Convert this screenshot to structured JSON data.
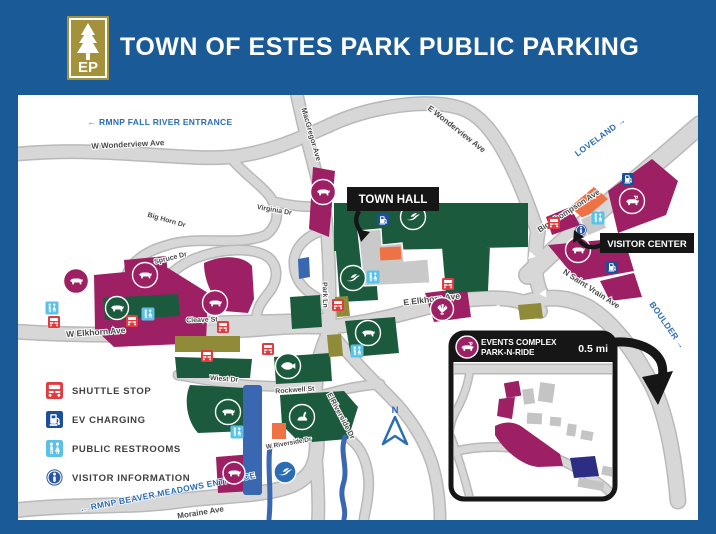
{
  "header": {
    "title": "TOWN OF ESTES PARK PUBLIC PARKING",
    "logo_text": "EP"
  },
  "legend": {
    "items": [
      {
        "icon": "shuttle-stop-icon",
        "label": "SHUTTLE STOP"
      },
      {
        "icon": "ev-charging-icon",
        "label": "EV CHARGING"
      },
      {
        "icon": "public-restrooms-icon",
        "label": "PUBLIC RESTROOMS"
      },
      {
        "icon": "visitor-information-icon",
        "label": "VISITOR INFORMATION"
      }
    ]
  },
  "map": {
    "north_label": "N",
    "poi_labels": {
      "town_hall": "TOWN HALL",
      "visitor_center": "VISITOR CENTER"
    },
    "direction_signs": [
      {
        "text": "← RMNP FALL RIVER ENTRANCE",
        "x": 142,
        "y": 30,
        "r": 0,
        "s": 8.5
      },
      {
        "text": "LOVELAND →",
        "x": 584,
        "y": 44,
        "r": -36,
        "s": 8.5
      },
      {
        "text": "BOULDER →",
        "x": 647,
        "y": 232,
        "r": 55,
        "s": 8.5
      },
      {
        "text": "← RMNP BEAVER MEADOWS ENTRANCE",
        "x": 150,
        "y": 400,
        "r": -11,
        "s": 8.5
      }
    ],
    "street_labels": [
      {
        "text": "W Wonderview Ave",
        "x": 110,
        "y": 52,
        "r": -3,
        "s": 8
      },
      {
        "text": "E Wonderview Ave",
        "x": 437,
        "y": 36,
        "r": 38,
        "s": 8
      },
      {
        "text": "Virginia Dr",
        "x": 256,
        "y": 117,
        "r": 10,
        "s": 7
      },
      {
        "text": "Big Horn Dr",
        "x": 148,
        "y": 127,
        "r": 16,
        "s": 7
      },
      {
        "text": "MacGregor Ave",
        "x": 291,
        "y": 40,
        "r": 74,
        "s": 7.5
      },
      {
        "text": "Big Thompson Ave",
        "x": 552,
        "y": 118,
        "r": -33,
        "s": 8
      },
      {
        "text": "N Saint Vrain Ave",
        "x": 572,
        "y": 196,
        "r": 33,
        "s": 8
      },
      {
        "text": "E Elkhorn Ave",
        "x": 414,
        "y": 207,
        "r": -7,
        "s": 8.5
      },
      {
        "text": "W Elkhorn Ave",
        "x": 78,
        "y": 240,
        "r": -4,
        "s": 8.5
      },
      {
        "text": "Cleave St",
        "x": 184,
        "y": 227,
        "r": -2,
        "s": 7
      },
      {
        "text": "Park Ln",
        "x": 305,
        "y": 200,
        "r": 88,
        "s": 7
      },
      {
        "text": "Spruce Dr",
        "x": 153,
        "y": 165,
        "r": -14,
        "s": 7
      },
      {
        "text": "Wiest Dr",
        "x": 206,
        "y": 286,
        "r": 4,
        "s": 7
      },
      {
        "text": "Rockwell St",
        "x": 277,
        "y": 297,
        "r": -4,
        "s": 7
      },
      {
        "text": "E Riverside Dr",
        "x": 321,
        "y": 322,
        "r": 62,
        "s": 7.5
      },
      {
        "text": "W Riverside Dr",
        "x": 271,
        "y": 350,
        "r": -10,
        "s": 6.5
      },
      {
        "text": "Moraine Ave",
        "x": 183,
        "y": 420,
        "r": -9,
        "s": 8
      },
      {
        "text": "N Saint Vrain Ave",
        "x": 567,
        "y": 277,
        "r": 0,
        "s": 6.5
      },
      {
        "text": "4th St",
        "x": 468,
        "y": 314,
        "r": 76,
        "s": 6
      },
      {
        "text": "Manford Ave",
        "x": 489,
        "y": 370,
        "r": 4,
        "s": 6
      },
      {
        "text": "S Saint Vrain Ave",
        "x": 447,
        "y": 375,
        "r": 66,
        "s": 5.5
      }
    ],
    "markers": [
      {
        "type": "shuttle",
        "x": 36,
        "y": 227
      },
      {
        "type": "shuttle",
        "x": 114,
        "y": 226
      },
      {
        "type": "shuttle",
        "x": 205,
        "y": 232
      },
      {
        "type": "shuttle",
        "x": 189,
        "y": 261
      },
      {
        "type": "shuttle",
        "x": 250,
        "y": 254
      },
      {
        "type": "shuttle",
        "x": 320,
        "y": 210
      },
      {
        "type": "shuttle",
        "x": 430,
        "y": 189
      },
      {
        "type": "shuttle",
        "x": 536,
        "y": 128
      },
      {
        "type": "ev",
        "x": 365,
        "y": 125
      },
      {
        "type": "ev",
        "x": 610,
        "y": 84
      },
      {
        "type": "ev",
        "x": 594,
        "y": 172
      },
      {
        "type": "restroom",
        "x": 34,
        "y": 213
      },
      {
        "type": "restroom",
        "x": 130,
        "y": 219
      },
      {
        "type": "restroom",
        "x": 355,
        "y": 182
      },
      {
        "type": "restroom",
        "x": 339,
        "y": 256
      },
      {
        "type": "restroom",
        "x": 219,
        "y": 337
      },
      {
        "type": "restroom",
        "x": 580,
        "y": 123
      },
      {
        "type": "restroom",
        "x": 552,
        "y": 339,
        "s": 8
      },
      {
        "type": "restroom",
        "x": 559,
        "y": 347,
        "s": 8
      },
      {
        "type": "info",
        "x": 563,
        "y": 135
      }
    ],
    "lot_markers": [
      {
        "animal": "mountain-lion",
        "symbol": "quad",
        "fill": "magenta",
        "x": 58,
        "y": 186
      },
      {
        "animal": "marten",
        "symbol": "quad",
        "fill": "magenta",
        "x": 127,
        "y": 180
      },
      {
        "animal": "bobcat",
        "symbol": "quad",
        "fill": "magenta",
        "x": 197,
        "y": 208
      },
      {
        "animal": "marmot",
        "symbol": "quad",
        "fill": "green",
        "x": 99,
        "y": 213,
        "rr": 11.5
      },
      {
        "animal": "bighorn-sheep",
        "symbol": "quad",
        "fill": "magenta",
        "x": 305,
        "y": 97
      },
      {
        "animal": "dove",
        "symbol": "bird",
        "fill": "green",
        "x": 335,
        "y": 183
      },
      {
        "animal": "eagle",
        "symbol": "bird",
        "fill": "green",
        "x": 395,
        "y": 122
      },
      {
        "animal": "elk",
        "symbol": "elk",
        "fill": "magenta",
        "x": 614,
        "y": 106
      },
      {
        "animal": "bear",
        "symbol": "quad",
        "fill": "magenta",
        "x": 560,
        "y": 155
      },
      {
        "animal": "wild-turkey",
        "symbol": "turkey",
        "fill": "magenta",
        "x": 424,
        "y": 214,
        "rr": 11.5
      },
      {
        "animal": "otter",
        "symbol": "quad",
        "fill": "green",
        "x": 350,
        "y": 238
      },
      {
        "animal": "trout",
        "symbol": "fish",
        "fill": "green",
        "x": 270,
        "y": 271
      },
      {
        "animal": "rabbit",
        "symbol": "rabbit",
        "fill": "green",
        "x": 284,
        "y": 322
      },
      {
        "animal": "black-bear",
        "symbol": "quad",
        "fill": "green",
        "x": 210,
        "y": 317
      },
      {
        "animal": "coyote",
        "symbol": "quad",
        "fill": "magenta",
        "x": 216,
        "y": 378,
        "rr": 11
      },
      {
        "animal": "dove",
        "symbol": "bird",
        "fill": "blue",
        "x": 267,
        "y": 377,
        "rr": 11
      }
    ]
  },
  "inset": {
    "title_line1": "EVENTS COMPLEX",
    "title_line2": "PARK-N-RIDE",
    "distance": "0.5 mi"
  },
  "colors": {
    "header_blue": "#1a5b97",
    "direction_blue": "#2a6db5",
    "paid_magenta": "#9c2063",
    "free_green": "#1b5a3c",
    "permit_olive": "#8f8b38",
    "structure_blue": "#3a67b1",
    "shuttle_red": "#e23b3f",
    "ev_navy": "#1b4f9c",
    "restroom_blue": "#5bc2e7",
    "info_navy": "#2b56a4",
    "orange": "#ef7146"
  }
}
